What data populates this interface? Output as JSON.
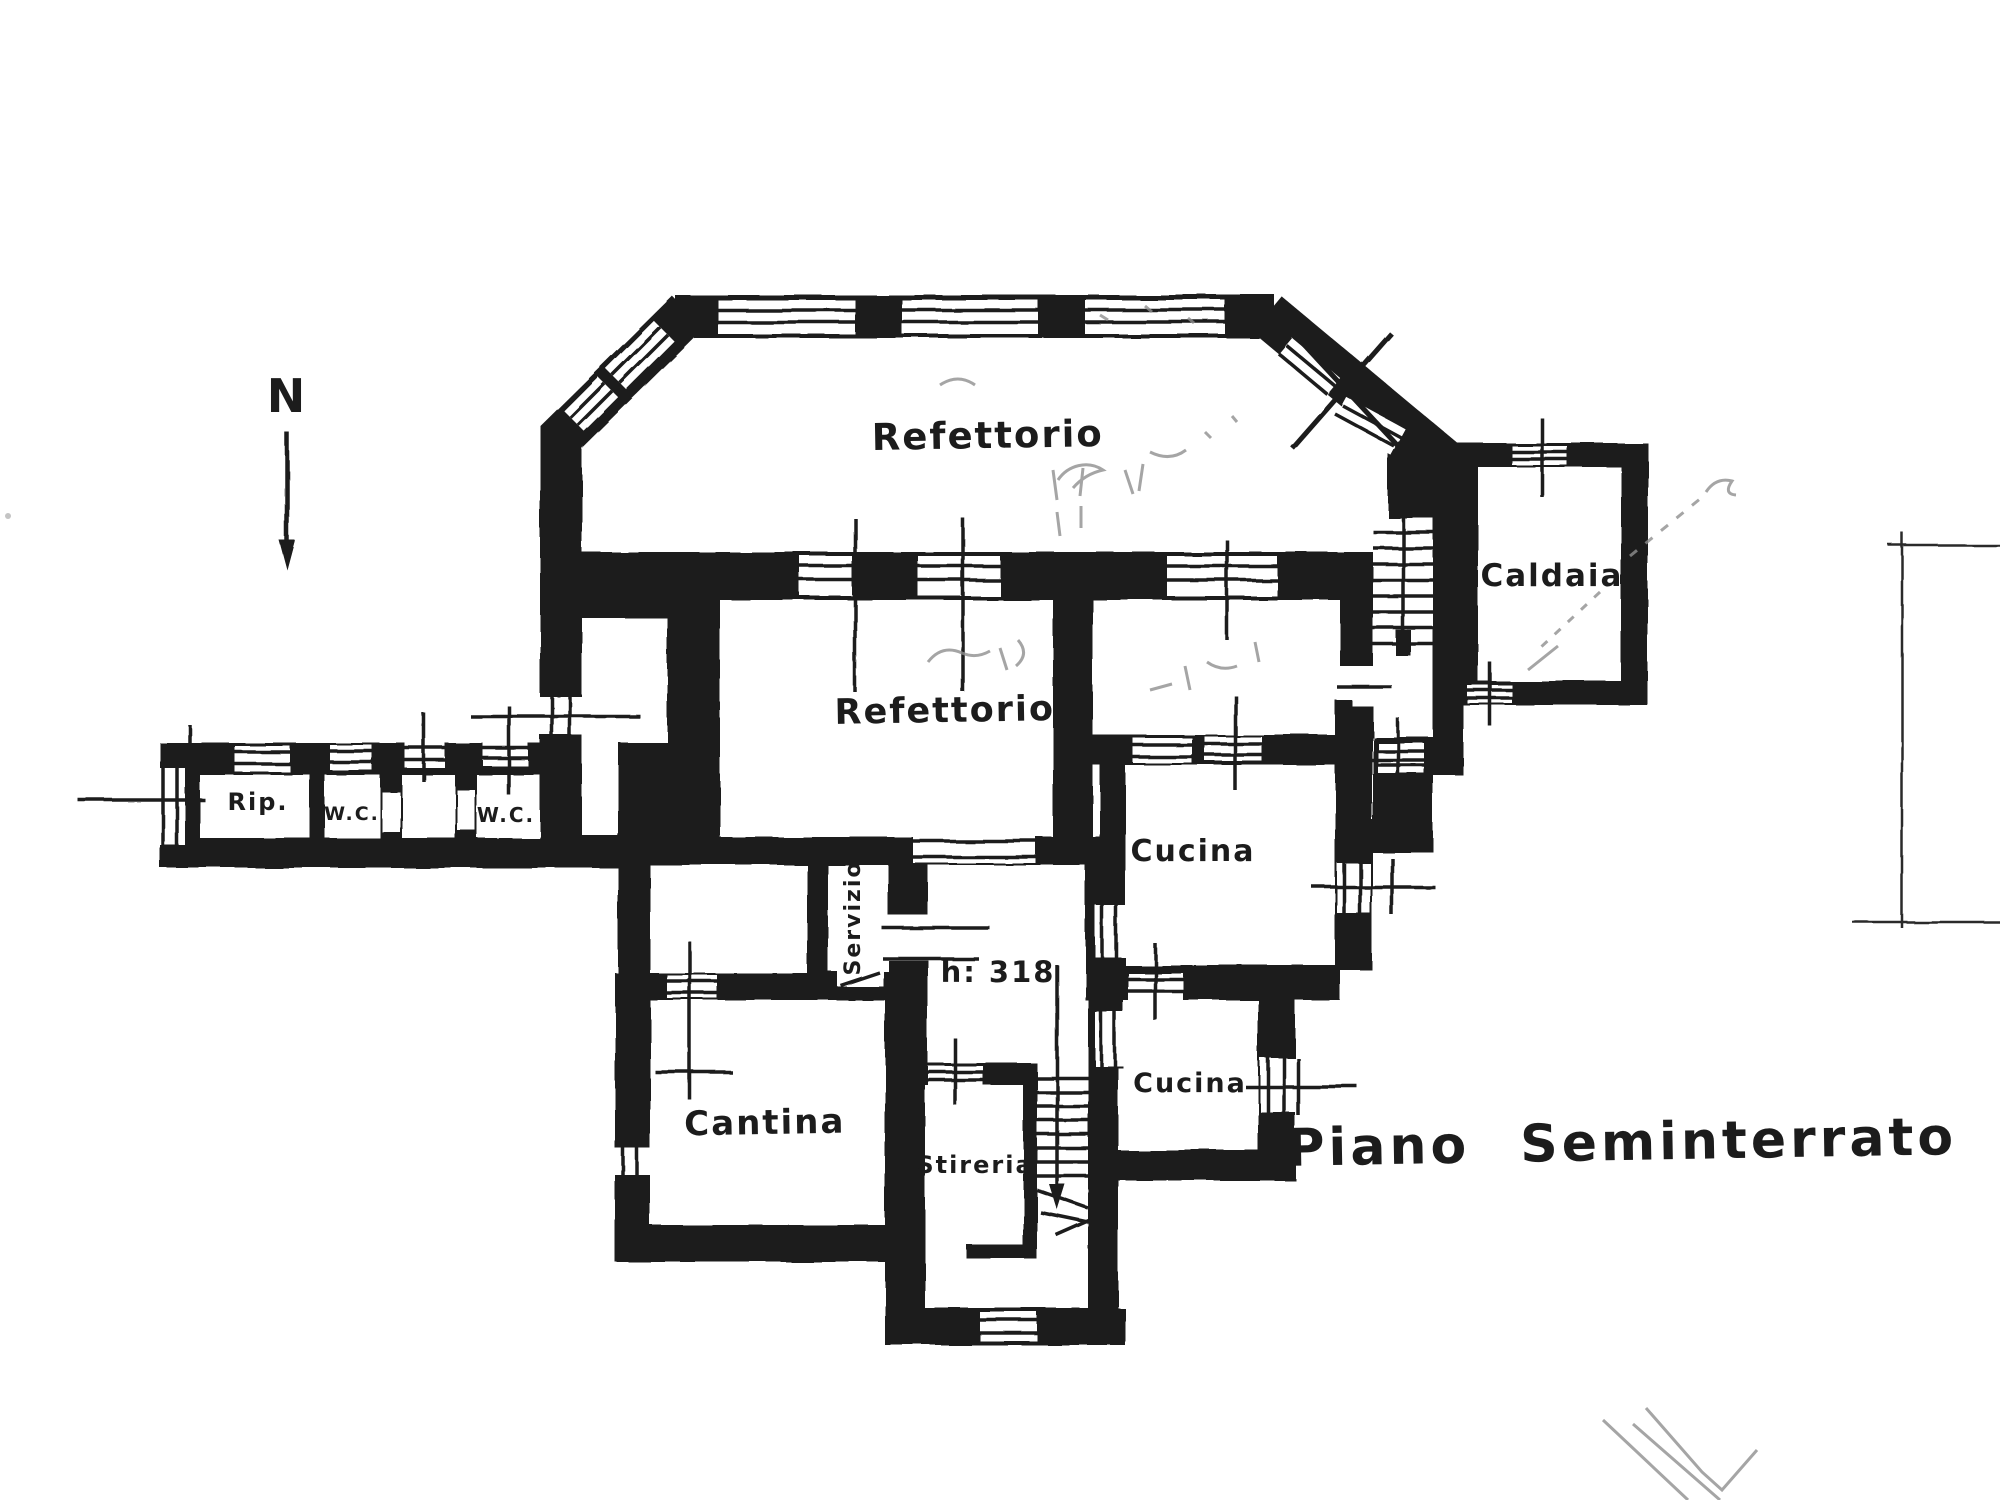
{
  "drawing": {
    "title": "Piano Seminterrato",
    "north_label": "N",
    "paper_color": "#ffffff",
    "ink_color": "#1b1b1b",
    "pencil_color": "#8f8f8f"
  },
  "rooms": [
    {
      "id": "refettorio-large",
      "label": "Refettorio"
    },
    {
      "id": "refettorio-small",
      "label": "Refettorio"
    },
    {
      "id": "caldaia",
      "label": "Caldaia"
    },
    {
      "id": "ripostiglio",
      "label": "Rip."
    },
    {
      "id": "wc-left",
      "label": "W.C."
    },
    {
      "id": "wc-right",
      "label": "W.C."
    },
    {
      "id": "servizio",
      "label": "Servizio"
    },
    {
      "id": "cucina-upper",
      "label": "Cucina"
    },
    {
      "id": "cucina-lower",
      "label": "Cucina"
    },
    {
      "id": "cantina",
      "label": "Cantina"
    },
    {
      "id": "stireria",
      "label": "Stireria"
    }
  ],
  "annotations": {
    "ceiling_height": "h: 318"
  }
}
